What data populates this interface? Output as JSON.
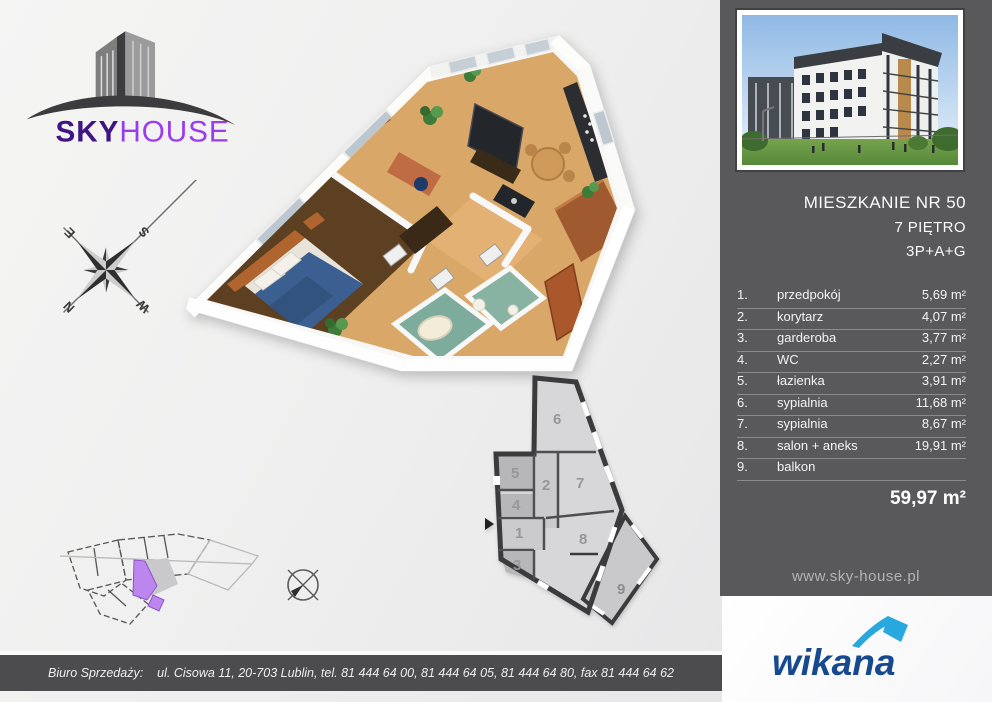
{
  "brand": {
    "sky": "SKY",
    "house": "HOUSE"
  },
  "compass": {
    "n": "N",
    "e": "E",
    "s": "S",
    "w": "W"
  },
  "panel": {
    "title": "MIESZKANIE NR 50",
    "floor": "7 PIĘTRO",
    "layout_code": "3P+A+G",
    "rooms": [
      {
        "num": "1.",
        "name": "przedpokój",
        "area": "5,69 m²"
      },
      {
        "num": "2.",
        "name": "korytarz",
        "area": "4,07 m²"
      },
      {
        "num": "3.",
        "name": "garderoba",
        "area": "3,77 m²"
      },
      {
        "num": "4.",
        "name": "WC",
        "area": "2,27 m²"
      },
      {
        "num": "5.",
        "name": "łazienka",
        "area": "3,91 m²"
      },
      {
        "num": "6.",
        "name": "sypialnia",
        "area": "11,68 m²"
      },
      {
        "num": "7.",
        "name": "sypialnia",
        "area": "8,67 m²"
      },
      {
        "num": "8.",
        "name": "salon + aneks",
        "area": "19,91 m²"
      },
      {
        "num": "9.",
        "name": "balkon",
        "area": ""
      }
    ],
    "total": "59,97 m²",
    "website": "www.sky-house.pl"
  },
  "plan2d": {
    "room_numbers": [
      "1",
      "2",
      "3",
      "4",
      "5",
      "6",
      "7",
      "8",
      "9"
    ]
  },
  "footer": {
    "label": "Biuro Sprzedaży:",
    "address": "ul. Cisowa 11, 20-703 Lublin, tel. 81 444 64 00, 81 444 64 05, 81 444 64 80, fax 81 444 64 62"
  },
  "wikana": {
    "name": "wikana"
  },
  "colors": {
    "brand_dark_purple": "#3f1582",
    "brand_light_purple": "#9a3bf0",
    "panel_gray": "#59595b",
    "footer_gray": "#4c4c4e",
    "unit_highlight_purple": "#bd85ee",
    "wikana_navy": "#17498f",
    "wikana_lightblue": "#29a8df"
  }
}
